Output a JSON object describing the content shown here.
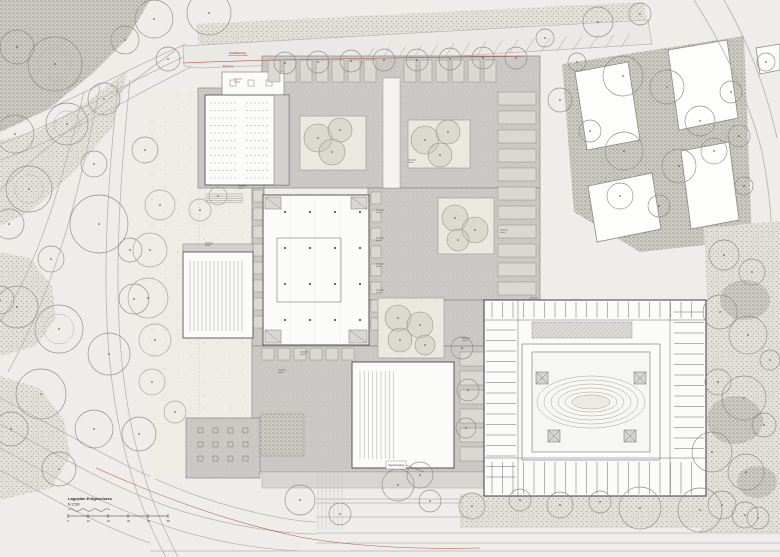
{
  "drawing": {
    "type": "architectural-site-plan",
    "scale_block": {
      "line1": "Lageplan Erdgeschoss",
      "line2": "M 1:500",
      "bar_ticks": [
        "0",
        "10",
        "20",
        "30",
        "40",
        "50"
      ]
    },
    "annotations": {
      "red_label_1": "Anlieferung",
      "red_label_2": "Eingang",
      "entrance_label": "Haupteingang"
    },
    "colors": {
      "bg": "#efedea",
      "roadLine": "#b7b5b1",
      "stipBg": "#e2e1d9",
      "stipDot": "#96968c",
      "stipDarkBg": "#cfcec6",
      "stipDarkDot": "#7d7d72",
      "paving": "#cac9c5",
      "pavingDot": "#bab9b4",
      "wall": "#55554f",
      "oldWall": "#4c4c52",
      "white": "#fbfbfa",
      "courtyard": "#eae9df",
      "treeFill": "#c3c6b4",
      "treeStroke": "#8f8e88",
      "plaza": "#edece5",
      "plazaDot": "#b5b3ad",
      "sidewalk": "#d8d6d2",
      "red": "#b23b31",
      "ink": "#2a2a28"
    },
    "landscape": {
      "stipple_dark": [
        "0,0 150,0 128,38 92,74 52,106 22,122 0,132"
      ],
      "stipple_light": [
        "196,24 644,2 647,22 199,46",
        "0,140 36,132 78,108 128,70 112,128 70,176 30,212 0,226",
        "0,252 30,258 52,286 56,318 36,346 0,356",
        "0,376 40,388 64,420 70,456 52,488 0,500"
      ],
      "road_curves": [
        "M186,44 C120,72 60,108 0,128",
        "M190,54 C124,84 62,122 0,144",
        "M197,64 C130,96 66,138 0,160",
        "M176,50 C120,90 40,150 0,190",
        "M84,92 C62,180 40,262 0,322",
        "M100,86 C80,190 58,282 8,372",
        "M118,82 C104,220 96,356 130,470 C140,504 152,532 166,557",
        "M130,80 C116,220 108,356 142,468 C152,502 164,530 178,557",
        "M0,398 C62,430 122,468 192,494 C246,513 292,521 316,522",
        "M0,424 C60,456 118,492 188,513 C240,528 290,534 316,534",
        "M0,448 C56,478 112,510 178,530 C220,543 260,549 300,551",
        "M0,470 C50,498 100,526 150,543"
      ],
      "top_street": {
        "poly": "183,46 648,20 652,44 360,62 200,68 184,66",
        "parking": {
          "x0": 365,
          "x1": 630,
          "step": 16
        }
      }
    },
    "district_ne": {
      "stipple": "562,64 744,36 752,240 640,252 574,212",
      "buildings": [
        "575,72 628,62 640,140 587,150",
        "668,50 727,40 738,118 679,130",
        "588,186 652,173 661,229 597,242",
        "681,151 729,142 739,220 691,229",
        "756,48 780,44 780,70 760,74"
      ],
      "roads": [
        "M694,0 C722,44 748,96 762,152 C770,192 773,228 771,262",
        "M724,0 C748,42 766,88 777,138"
      ]
    },
    "plaza": {
      "poly": "146,92 262,92 262,420 186,420 186,472 150,480 140,300 142,150",
      "dot_region": [
        152,
        96,
        258,
        416
      ],
      "steps": [
        205,
        194,
        38,
        10
      ]
    },
    "complex": {
      "paving": [
        [
          262,
          56,
          278,
          132
        ],
        [
          198,
          88,
          66,
          100
        ],
        [
          368,
          188,
          172,
          112
        ],
        [
          368,
          300,
          132,
          46
        ],
        [
          252,
          188,
          12,
          158
        ],
        [
          252,
          346,
          248,
          126
        ],
        [
          186,
          418,
          74,
          60
        ]
      ],
      "sidewalk": [
        262,
        472,
        250,
        16
      ],
      "corridor": [
        383,
        78,
        17,
        110
      ],
      "annex": [
        222,
        72,
        62,
        26
      ],
      "courtyards": [
        {
          "r": [
            300,
            116,
            66,
            54
          ],
          "trees": [
            [
              318,
              138,
              14
            ],
            [
              340,
              130,
              12
            ],
            [
              332,
              152,
              13
            ]
          ]
        },
        {
          "r": [
            408,
            120,
            62,
            48
          ],
          "trees": [
            [
              425,
              140,
              14
            ],
            [
              448,
              132,
              12
            ],
            [
              440,
              155,
              12
            ]
          ]
        },
        {
          "r": [
            438,
            198,
            56,
            56
          ],
          "trees": [
            [
              455,
              218,
              13
            ],
            [
              475,
              230,
              13
            ],
            [
              458,
              240,
              11
            ]
          ]
        },
        {
          "r": [
            378,
            298,
            66,
            60
          ],
          "trees": [
            [
              398,
              318,
              13
            ],
            [
              420,
              325,
              13
            ],
            [
              400,
              340,
              12
            ],
            [
              425,
              345,
              10
            ]
          ]
        }
      ],
      "main_hall": {
        "rect": [
          263,
          195,
          106,
          150
        ],
        "inner": [
          277,
          238,
          64,
          64
        ],
        "cols_x": [
          285,
          310,
          335,
          360
        ],
        "cols_y": [
          212,
          248,
          284,
          320
        ],
        "cores": [
          [
            265,
            197,
            16,
            12
          ],
          [
            351,
            197,
            16,
            12
          ],
          [
            265,
            330,
            16,
            13
          ],
          [
            349,
            330,
            18,
            13
          ]
        ]
      },
      "lecture_hall": {
        "rect": [
          205,
          95,
          84,
          90
        ],
        "seats": {
          "x0": 211,
          "x1": 268,
          "dx": 4,
          "y0": 103,
          "y1": 178,
          "dy": 7.5,
          "aisle": [
            237,
            243
          ]
        },
        "service": [
          274,
          95,
          15,
          90
        ]
      },
      "auditorium": {
        "rect": [
          183,
          252,
          70,
          86
        ],
        "lines": {
          "x0": 190,
          "x1": 243,
          "dx": 4,
          "y0": 261,
          "y1": 331
        }
      },
      "sports_hall": {
        "rect": [
          352,
          362,
          102,
          106
        ],
        "lines": {
          "x0": 360,
          "x1": 394,
          "dx": 4.2,
          "y0": 371,
          "y1": 459
        }
      },
      "cafe": {
        "rect": [
          186,
          418,
          74,
          60
        ],
        "tables": {
          "x0": 198,
          "y0": 428,
          "dx": 15,
          "dy": 14,
          "nx": 4,
          "ny": 3
        },
        "hatch": [
          260,
          414,
          44,
          42
        ]
      },
      "modules": [
        {
          "dir": "x",
          "x0": 268,
          "x1": 364,
          "step": 16,
          "y": 60,
          "w": 12,
          "h": 22
        },
        {
          "dir": "x",
          "x0": 404,
          "x1": 488,
          "step": 16,
          "y": 60,
          "w": 12,
          "h": 22
        },
        {
          "dir": "y",
          "y0": 92,
          "y1": 292,
          "step": 19,
          "x": 498,
          "w": 38,
          "h": 13
        },
        {
          "dir": "x",
          "x0": 262,
          "x1": 350,
          "step": 16,
          "y": 348,
          "w": 12,
          "h": 12
        },
        {
          "dir": "y",
          "y0": 352,
          "y1": 456,
          "step": 19,
          "x": 460,
          "w": 36,
          "h": 14
        },
        {
          "dir": "y",
          "y0": 190,
          "y1": 332,
          "step": 18,
          "x": 253,
          "w": 10,
          "h": 12
        },
        {
          "dir": "y",
          "y0": 192,
          "y1": 330,
          "step": 18,
          "x": 371,
          "w": 10,
          "h": 12
        }
      ]
    },
    "old_building": {
      "outer": [
        484,
        300,
        222,
        196
      ],
      "ring": [
        522,
        344,
        138,
        116
      ],
      "court": [
        532,
        352,
        118,
        100
      ],
      "ellipse_c": [
        591,
        402
      ],
      "ellipse_r": [
        [
          54,
          26
        ],
        [
          47,
          22
        ],
        [
          40,
          18
        ],
        [
          33,
          14
        ],
        [
          26,
          10
        ],
        [
          19,
          7
        ]
      ],
      "hatch": [
        532,
        322,
        100,
        16
      ],
      "cores": [
        [
          536,
          372
        ],
        [
          634,
          372
        ],
        [
          548,
          430
        ],
        [
          624,
          430
        ]
      ],
      "walls": [
        [
          484,
          320,
          706,
          320
        ],
        [
          484,
          458,
          706,
          458
        ],
        [
          518,
          300,
          518,
          497
        ],
        [
          670,
          300,
          670,
          497
        ]
      ],
      "ticks": [
        {
          "dir": "v",
          "a0": 492,
          "a1": 700,
          "step": 10.5,
          "b0": 302,
          "b1": 318
        },
        {
          "dir": "h",
          "a0": 330,
          "a1": 486,
          "step": 10.5,
          "b0": 486,
          "b1": 516
        },
        {
          "dir": "h",
          "a0": 312,
          "a1": 452,
          "step": 10.5,
          "b0": 674,
          "b1": 704
        },
        {
          "dir": "v",
          "a0": 492,
          "a1": 700,
          "step": 10.5,
          "b0": 462,
          "b1": 494
        }
      ]
    },
    "garden": {
      "right_poly": "704,228 780,221 780,532 700,532 702,400 707,300",
      "bottom_rect": [
        460,
        494,
        320,
        34
      ],
      "dark_blobs": [
        [
          745,
          300,
          25,
          20
        ],
        [
          735,
          420,
          28,
          24
        ],
        [
          757,
          482,
          20,
          16
        ]
      ]
    },
    "bottom_street": {
      "lines": [
        [
          316,
          499,
          462,
          499
        ],
        [
          316,
          503,
          462,
          503
        ],
        [
          316,
          517,
          470,
          517
        ],
        [
          316,
          533,
          780,
          533
        ],
        [
          316,
          543,
          780,
          543
        ],
        [
          150,
          551,
          780,
          551
        ]
      ],
      "hatch": [
        318,
        470,
        26,
        60
      ]
    },
    "trees": {
      "field": [
        [
          55,
          64,
          27
        ],
        [
          17,
          47,
          17
        ],
        [
          104,
          99,
          16
        ],
        [
          67,
          124,
          21
        ],
        [
          15,
          134,
          19
        ],
        [
          94,
          164,
          13
        ],
        [
          29,
          189,
          23
        ],
        [
          99,
          224,
          29
        ],
        [
          9,
          224,
          15
        ],
        [
          51,
          259,
          13
        ],
        [
          134,
          299,
          15
        ],
        [
          17,
          307,
          21
        ],
        [
          59,
          329,
          24
        ],
        [
          109,
          354,
          21
        ],
        [
          41,
          394,
          25
        ],
        [
          11,
          429,
          17
        ],
        [
          94,
          429,
          19
        ],
        [
          139,
          434,
          17
        ],
        [
          59,
          469,
          17
        ],
        [
          154,
          19,
          19
        ],
        [
          209,
          13,
          22
        ],
        [
          168,
          59,
          12
        ],
        [
          0,
          300,
          14
        ],
        [
          130,
          250,
          12
        ],
        [
          145,
          150,
          13
        ],
        [
          125,
          40,
          14
        ],
        [
          598,
          22,
          15
        ],
        [
          640,
          14,
          11
        ],
        [
          577,
          62,
          9
        ],
        [
          623,
          76,
          20
        ],
        [
          667,
          87,
          17
        ],
        [
          700,
          121,
          15
        ],
        [
          590,
          131,
          11
        ],
        [
          624,
          151,
          19
        ],
        [
          679,
          166,
          17
        ],
        [
          714,
          151,
          13
        ],
        [
          739,
          136,
          11
        ],
        [
          620,
          196,
          13
        ],
        [
          659,
          206,
          11
        ],
        [
          744,
          186,
          9
        ],
        [
          731,
          92,
          11
        ],
        [
          766,
          62,
          9
        ],
        [
          560,
          100,
          12
        ],
        [
          545,
          38,
          9
        ],
        [
          724,
          255,
          15
        ],
        [
          752,
          272,
          13
        ],
        [
          720,
          312,
          17
        ],
        [
          748,
          335,
          19
        ],
        [
          718,
          382,
          13
        ],
        [
          744,
          398,
          22
        ],
        [
          712,
          452,
          20
        ],
        [
          746,
          472,
          18
        ],
        [
          722,
          505,
          14
        ],
        [
          758,
          518,
          11
        ],
        [
          764,
          425,
          12
        ],
        [
          770,
          360,
          10
        ],
        [
          300,
          500,
          15
        ],
        [
          340,
          514,
          11
        ],
        [
          398,
          485,
          16
        ],
        [
          430,
          501,
          11
        ],
        [
          472,
          506,
          13
        ],
        [
          520,
          500,
          11
        ],
        [
          560,
          505,
          13
        ],
        [
          600,
          502,
          11
        ],
        [
          640,
          508,
          21
        ],
        [
          700,
          510,
          22
        ],
        [
          745,
          515,
          13
        ],
        [
          462,
          348,
          11
        ],
        [
          468,
          390,
          11
        ],
        [
          466,
          428,
          10
        ],
        [
          420,
          475,
          13
        ]
      ],
      "plaza": [
        [
          160,
          205,
          15
        ],
        [
          150,
          250,
          17
        ],
        [
          148,
          298,
          20
        ],
        [
          155,
          340,
          16
        ],
        [
          152,
          382,
          13
        ],
        [
          175,
          412,
          11
        ],
        [
          200,
          210,
          11
        ],
        [
          218,
          196,
          9
        ]
      ],
      "top_row": [
        [
          285,
          63,
          11
        ],
        [
          318,
          62,
          11
        ],
        [
          351,
          61,
          11
        ],
        [
          384,
          60,
          11
        ],
        [
          417,
          60,
          11
        ],
        [
          450,
          59,
          11
        ],
        [
          483,
          58,
          11
        ],
        [
          516,
          58,
          11
        ]
      ]
    },
    "red": {
      "top_path": "M183,63 C250,60 320,59 390,58 C440,57 490,57 525,56",
      "bottom_path": "M96,468 C150,492 220,520 300,537 C360,548 430,549 480,548",
      "dashes": [
        [
          234,
          79,
          242,
          79
        ],
        [
          234,
          82,
          240,
          82
        ]
      ],
      "label1_pos": [
        229,
        54
      ],
      "label2_pos": [
        223,
        67
      ]
    },
    "label_stacks": [
      [
        376,
        210
      ],
      [
        376,
        238
      ],
      [
        376,
        264
      ],
      [
        376,
        290
      ],
      [
        300,
        352
      ],
      [
        238,
        186
      ],
      [
        462,
        338
      ],
      [
        530,
        298
      ],
      [
        205,
        243
      ],
      [
        278,
        370
      ],
      [
        408,
        160
      ],
      [
        500,
        230
      ]
    ],
    "dim_line": [
      199,
      95,
      199,
      415
    ],
    "scale_pos": [
      68,
      500
    ]
  }
}
